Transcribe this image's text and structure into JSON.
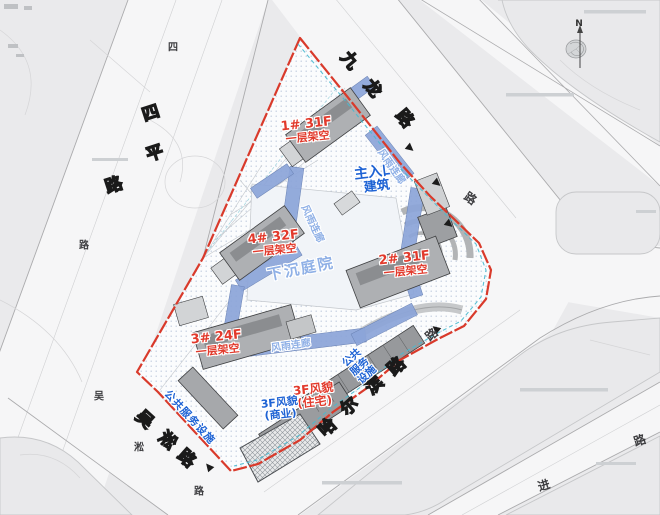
{
  "map": {
    "roads": {
      "jiulong": [
        "九",
        "龙",
        "路"
      ],
      "siping": [
        "四",
        "平",
        "路"
      ],
      "wusong": [
        "吴",
        "淞",
        "路"
      ],
      "haerbin": [
        "哈",
        "尔",
        "滨",
        "路"
      ],
      "small": [
        "四",
        "路",
        "吴",
        "淞",
        "路",
        "路",
        "路",
        "进",
        "路"
      ]
    },
    "buildings": [
      {
        "title": "1# 31F",
        "sub": "一层架空"
      },
      {
        "title": "2# 31F",
        "sub": "一层架空"
      },
      {
        "title": "3# 24F",
        "sub": "一层架空"
      },
      {
        "title": "4# 32F",
        "sub": "一层架空"
      }
    ],
    "annotations": {
      "entrance": [
        "主入口",
        "建筑"
      ],
      "courtyard": "下沉庭院",
      "corridor": "风雨连廊",
      "public_service": "公共服务设施",
      "public_service_stacked": [
        "公共",
        "服务",
        "设施"
      ],
      "heritage_residential": [
        "3F风貌",
        "(住宅)"
      ],
      "heritage_commercial": [
        "3F风貌",
        "(商业)"
      ]
    },
    "compass": "N",
    "colors": {
      "boundary_red": "#d93a2b",
      "label_red": "#e23a2c",
      "label_blue": "#1d62d4",
      "corridor_blue": "#8ca5d8",
      "label_lightblue": "#8fb0e6",
      "teal_dash": "#49b9cf"
    }
  }
}
